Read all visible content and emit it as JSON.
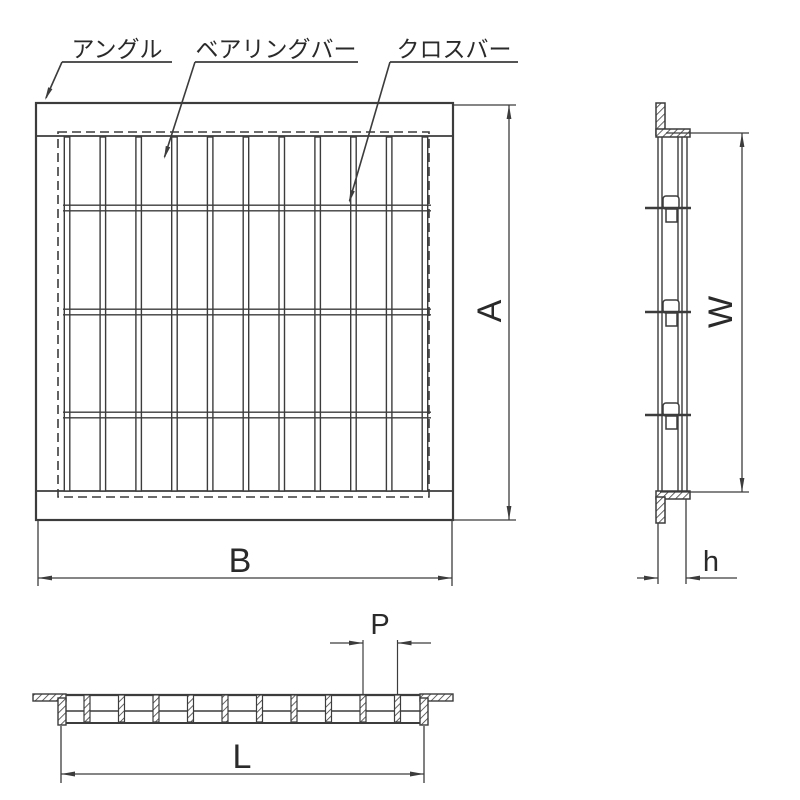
{
  "callouts": {
    "angle": "アングル",
    "bearing_bar": "ベアリングバー",
    "cross_bar": "クロスバー"
  },
  "dimensions": {
    "overall_height": "A",
    "overall_width": "B",
    "panel_width": "W",
    "bar_height": "h",
    "bar_pitch": "P",
    "clear_span": "L"
  },
  "colors": {
    "line": "#3c3c3c",
    "label": "#2a2a2a",
    "h_label": "#2f5e8f",
    "background": "#ffffff"
  }
}
